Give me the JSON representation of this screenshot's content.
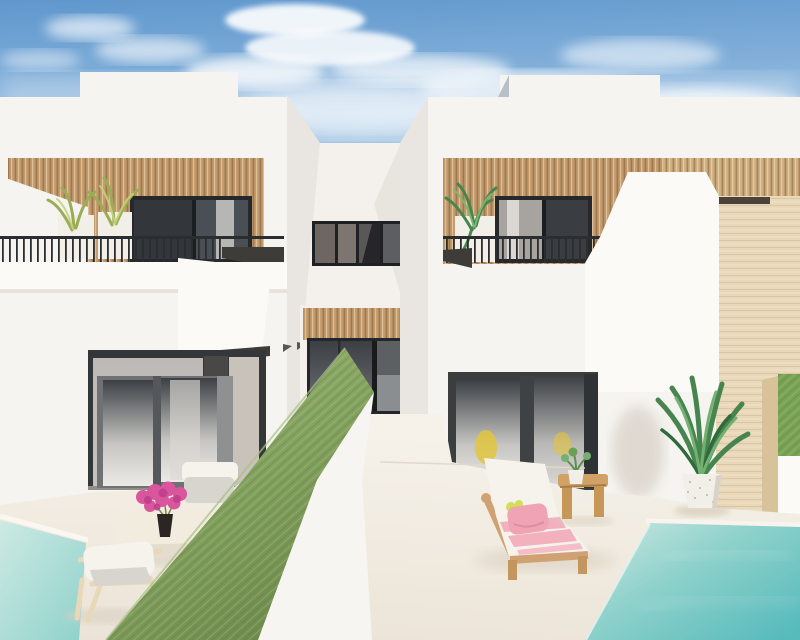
{
  "meta": {
    "title": "Architectural render: modern white villas with wood-slat facades, green privacy wall, terrace furniture and swimming pools",
    "domain_note": "photorealistic exterior render, no text or UI controls visible"
  },
  "scene": {
    "sky": {
      "description": "blue sky with scattered cumulus clouds",
      "bird_count": 1
    },
    "buildings": {
      "left_villa": {
        "features": [
          "white roof parapet",
          "wood slat upper facade",
          "black balcony railing",
          "balcony palm planters",
          "dark picture window",
          "ground floor sliding doors"
        ]
      },
      "center_block": {
        "features": [
          "recessed white tower",
          "dark ribbon window",
          "wood slat band",
          "dark sliding glass doors"
        ]
      },
      "right_villa": {
        "features": [
          "white roof parapet",
          "wood slat upper facade",
          "black balcony railing",
          "balcony palm",
          "lime shrub",
          "ground floor sliding doors with yellow chairs inside"
        ]
      },
      "side_building": {
        "features": [
          "beige travertine tower",
          "dark reveal slot"
        ]
      }
    },
    "terrace": {
      "left_side": [
        "white outdoor sofa with grey cushion",
        "white coffee table",
        "pink bougainvillea in black vase",
        "pale wood lounge chair",
        "pool water corner"
      ],
      "divider": [
        "diagonal privacy wall topped with green artificial grass",
        "white wall face"
      ],
      "right_side": [
        "wooden sun lounger with white cushion, pink striped towel, pink pillow, lime accessory",
        "wooden arch side stool with potted succulent",
        "large potted palm with speckled white pot",
        "green hedge wall segment",
        "turquoise swimming pool"
      ]
    }
  },
  "colors": {
    "sky_top": "#5f97cd",
    "sky_mid": "#8fb8de",
    "sky_low": "#dae8f4",
    "cloud": "#ffffff",
    "wall_white": "#f6f4f0",
    "wall_bright": "#fbfaf7",
    "wall_shade": "#ece8e2",
    "side_shade": "#e9e5e0",
    "wood_base": "#c29a6c",
    "wood_base_light": "#cfae80",
    "slat_dark": "#7a5a38",
    "slat_light": "#f3e2c2",
    "frame_dark": "#26282b",
    "glass_dark": "#3c4045",
    "glass_mid": "#6e7276",
    "glass_light": "#c6c5c2",
    "curtain": "#dbd8d4",
    "railing": "#2b2e31",
    "fascia": "#3e3c39",
    "slot_dark": "#4b433a",
    "green_wall": "#87a562",
    "green_wall_light": "#9ab374",
    "green_wall_dark": "#6e8b4d",
    "hedge": "#79a355",
    "beige": "#e9d8ba",
    "beige_side": "#d8c29a",
    "beige_line": "#b99a6c",
    "floor": "#f6f2ea",
    "floor_shade": "#ebe3d6",
    "pool_light": "#cdeae3",
    "pool_mid": "#8fd1cb",
    "pool_deep": "#57bbbc",
    "lounger_wood": "#d0a273",
    "cushion_white": "#f6f3ed",
    "towel_pink": "#f3b0bd",
    "pillow_pink": "#f0a4b3",
    "accent_lime": "#d4dd57",
    "stool_wood": "#d2a166",
    "palm_green": "#47854f",
    "palm_dark": "#2f6a3c",
    "palm_light": "#74b072",
    "olive_plant": "#9aad55",
    "lime_plant": "#c2d45c",
    "flower_pink": "#d9569d",
    "flower_deep": "#bf3f8b",
    "pot_white": "#f2efe9",
    "chair_wood": "#e7d9b7",
    "pad_gray": "#d8d4ce",
    "interior_yellow": "#e2c53e",
    "bird": "#2e2c29"
  }
}
